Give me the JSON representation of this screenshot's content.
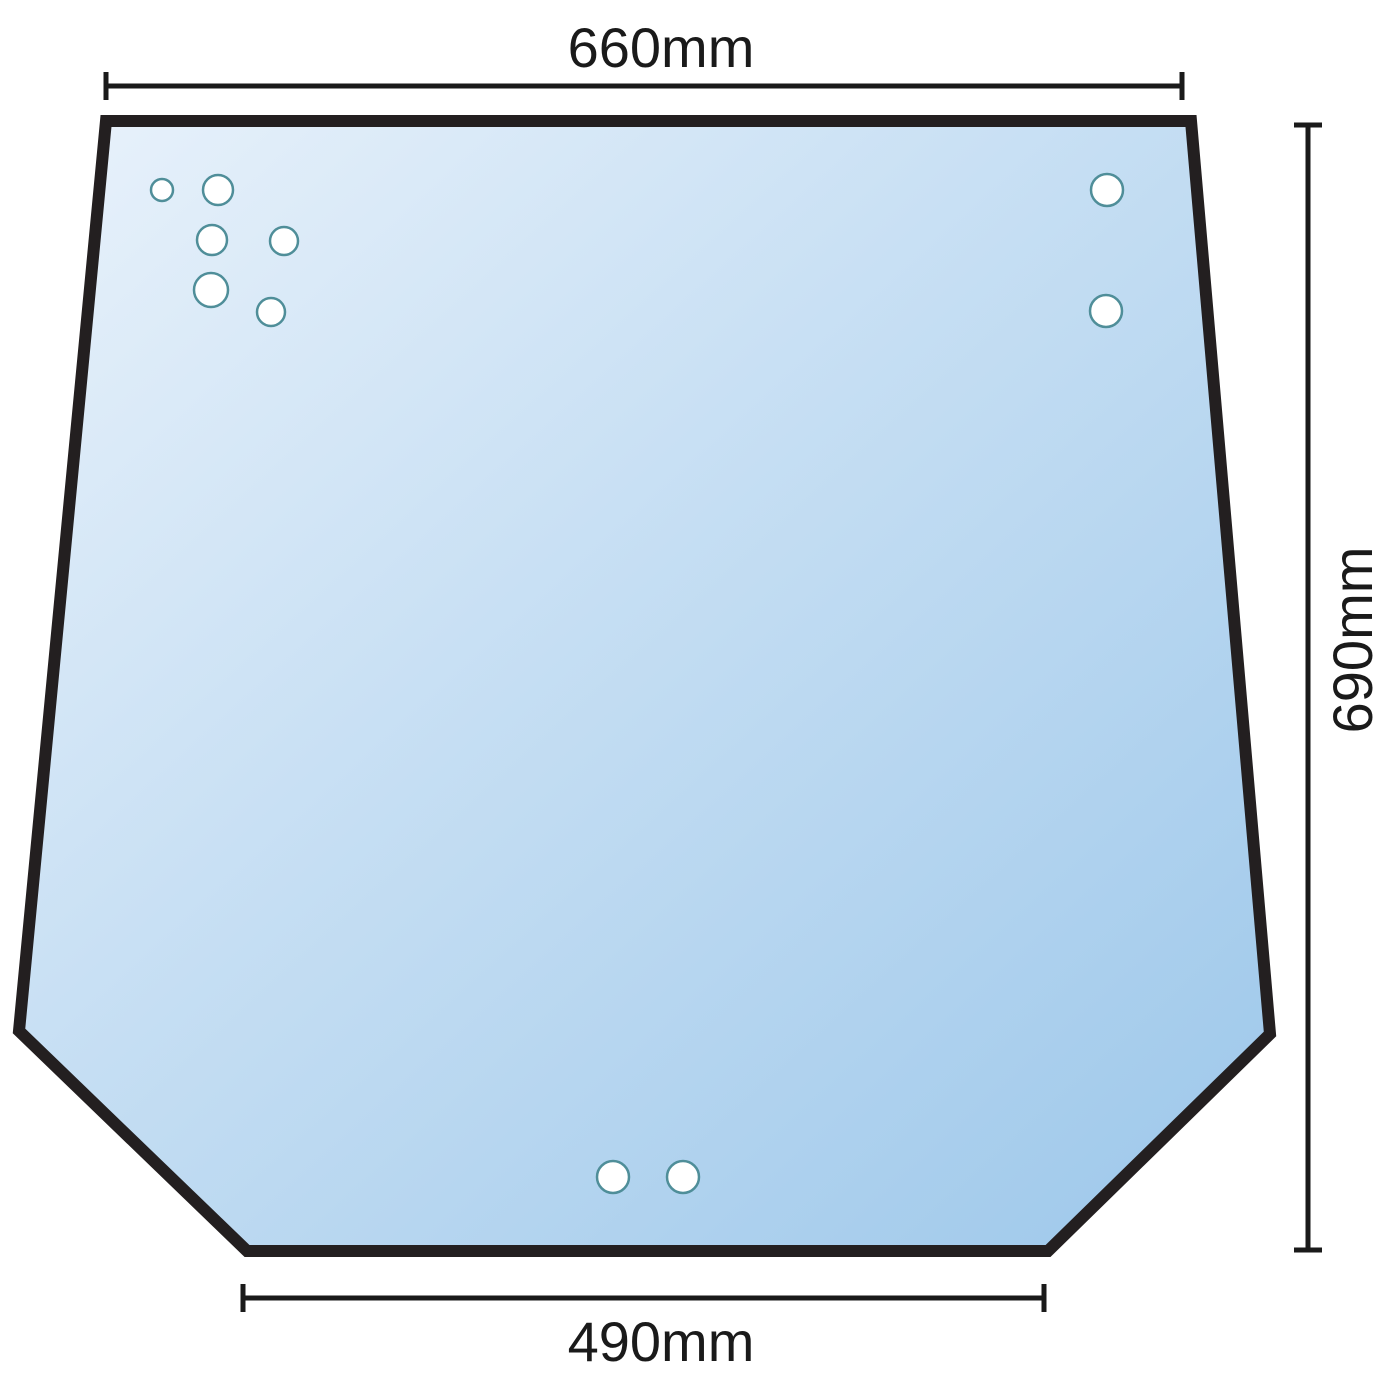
{
  "title": "Windscreen glass dimension diagram",
  "dimensions": {
    "top_width_label": "660mm",
    "height_label": "690mm",
    "bottom_width_label": "490mm"
  },
  "colors": {
    "outline": "#231f20",
    "dimension": "#1a1a1a",
    "glass_light": "#e9f2fb",
    "glass_mid": "#c5def3",
    "glass_deep": "#9cc7ea",
    "hole_ring": "#4f8e99",
    "hole_fill": "#ffffff"
  },
  "glass": {
    "outline_points": "106,121 1191,121 1270,1034 1048,1251 247,1251 19,1031"
  },
  "holes": [
    {
      "group": "top-left-cluster",
      "x": 162,
      "y": 190,
      "r": 11
    },
    {
      "group": "top-left-cluster",
      "x": 218,
      "y": 190,
      "r": 15
    },
    {
      "group": "top-left-cluster",
      "x": 212,
      "y": 240,
      "r": 15
    },
    {
      "group": "top-left-cluster",
      "x": 284,
      "y": 241,
      "r": 14
    },
    {
      "group": "top-left-cluster",
      "x": 211,
      "y": 290,
      "r": 17
    },
    {
      "group": "top-left-cluster",
      "x": 271,
      "y": 312,
      "r": 14
    },
    {
      "group": "top-right-pair",
      "x": 1107,
      "y": 190,
      "r": 16
    },
    {
      "group": "top-right-pair",
      "x": 1106,
      "y": 311,
      "r": 16
    },
    {
      "group": "bottom-center-pair",
      "x": 613,
      "y": 1177,
      "r": 16
    },
    {
      "group": "bottom-center-pair",
      "x": 683,
      "y": 1177,
      "r": 16
    }
  ]
}
